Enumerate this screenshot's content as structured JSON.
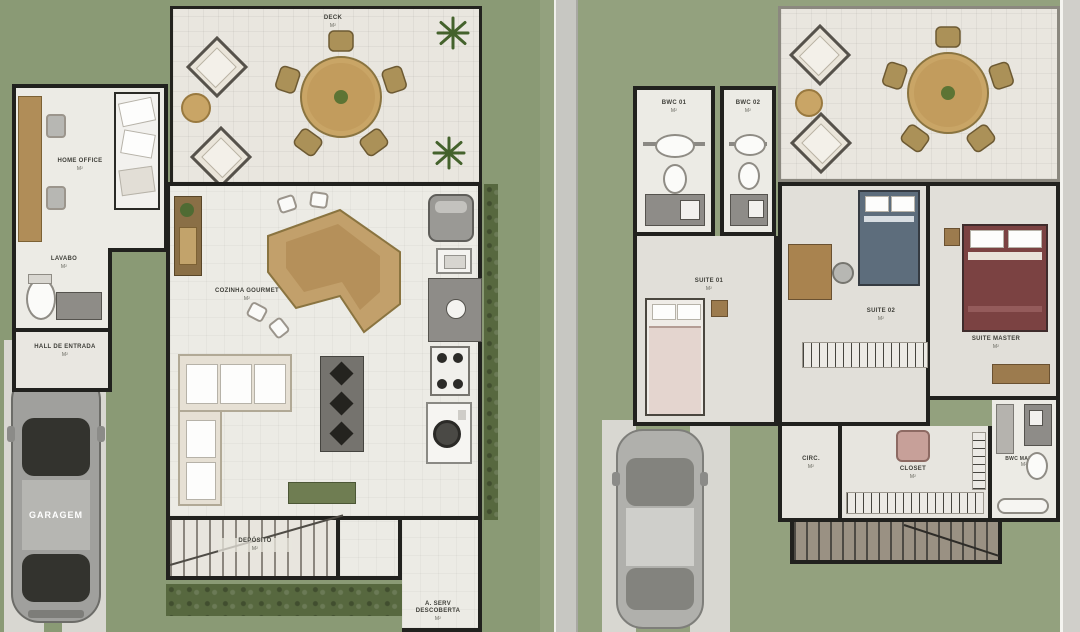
{
  "title": "House floor plans – ground floor and upper floor (top-down architectural rendering)",
  "palette": {
    "grass_left": "#8a9a75",
    "grass_right": "#93a17e",
    "wall": "#21211e",
    "interior_floor": "#ecebe5",
    "deck_floor": "#e9e6df",
    "wood_furniture": "#c9a566",
    "hedge": "#57683f",
    "car_body": "#a0a09d",
    "sidewalk": "#c7c7c2",
    "bed_master_cover": "#7b4242",
    "bed_suite02_cover": "#5d6d7c",
    "closet_ottoman": "#c7a099"
  },
  "plans": [
    {
      "name": "ground-floor",
      "rooms": [
        {
          "label": "DECK",
          "area": "m²"
        },
        {
          "label": "HOME OFFICE",
          "area": "m²"
        },
        {
          "label": "LAVABO",
          "area": "m²"
        },
        {
          "label": "HALL DE ENTRADA",
          "area": "m²"
        },
        {
          "label": "COZINHA GOURMET",
          "area": "m²"
        },
        {
          "label": "DEPÓSITO",
          "area": "m²"
        },
        {
          "label": "A. SERV DESCOBERTA",
          "area": "m²"
        }
      ],
      "car_label": "GARAGEM"
    },
    {
      "name": "upper-floor",
      "rooms": [
        {
          "label": "BWC 01",
          "area": "m²"
        },
        {
          "label": "BWC 02",
          "area": "m²"
        },
        {
          "label": "SUITE 01",
          "area": "m²"
        },
        {
          "label": "SUITE 02",
          "area": "m²"
        },
        {
          "label": "SUITE MASTER",
          "area": "m²"
        },
        {
          "label": "CIRC.",
          "area": "m²"
        },
        {
          "label": "CLOSET",
          "area": "m²"
        },
        {
          "label": "BWC MASTER",
          "area": "m²"
        }
      ]
    }
  ],
  "icons": {
    "dining-table-icon": "round tan table with 5 chairs",
    "lounge-chair-icon": "rotated square armchair",
    "pouf-icon": "small tan circle",
    "plant-icon": "green radial fronds",
    "car-icon": "grey sedan top view",
    "sofa-icon": "L-shaped beige sofa",
    "stairs-icon": "hatched treads with diagonal cut line",
    "hanger-rack-icon": "tick-mark clothes rail",
    "toilet-icon": "white oval with tank",
    "stove-icon": "4 burner circles",
    "fridge-icon": "rounded grey box"
  }
}
